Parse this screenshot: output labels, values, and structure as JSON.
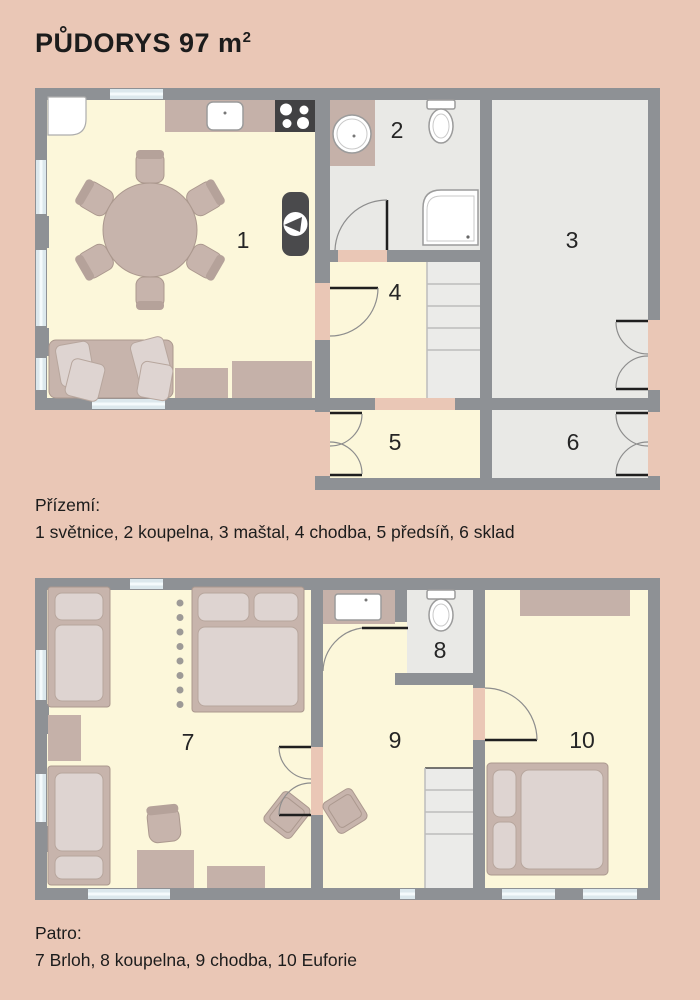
{
  "title": {
    "text": "PŮDORYS 97 m",
    "sup": "2"
  },
  "colors": {
    "background": "#eac7b6",
    "wall": "#8e9195",
    "room_warm": "#fcf7da",
    "room_gray": "#e9e9e6",
    "furniture": "#c7b4ac",
    "window": "#dce8ed",
    "appliance_dark": "#414143"
  },
  "ground_floor": {
    "caption_title": "Přízemí:",
    "caption_rooms": "1 světnice, 2 koupelna, 3 maštal, 4 chodba, 5 předsíň, 6 sklad",
    "rooms": [
      {
        "number": "1",
        "name": "světnice"
      },
      {
        "number": "2",
        "name": "koupelna"
      },
      {
        "number": "3",
        "name": "maštal"
      },
      {
        "number": "4",
        "name": "chodba"
      },
      {
        "number": "5",
        "name": "předsíň"
      },
      {
        "number": "6",
        "name": "sklad"
      }
    ],
    "fixtures": [
      "kitchen-counter",
      "kitchen-sink",
      "cooktop",
      "dining-table",
      "dining-chairs",
      "wood-stove",
      "sofa",
      "cushions",
      "sideboard",
      "washbasin",
      "toilet",
      "shower",
      "stairs",
      "windows",
      "doors"
    ]
  },
  "upper_floor": {
    "caption_title": "Patro:",
    "caption_rooms": "7 Brloh, 8 koupelna, 9 chodba, 10 Euforie",
    "rooms": [
      {
        "number": "7",
        "name": "Brloh"
      },
      {
        "number": "8",
        "name": "koupelna"
      },
      {
        "number": "9",
        "name": "chodba"
      },
      {
        "number": "10",
        "name": "Euforie"
      }
    ],
    "fixtures": [
      "single-bed",
      "double-bed",
      "nightstand",
      "desk",
      "desk-chair",
      "chairs",
      "dotted-divider",
      "washbasin",
      "toilet",
      "wardrobe",
      "stairs",
      "windows",
      "doors"
    ]
  }
}
